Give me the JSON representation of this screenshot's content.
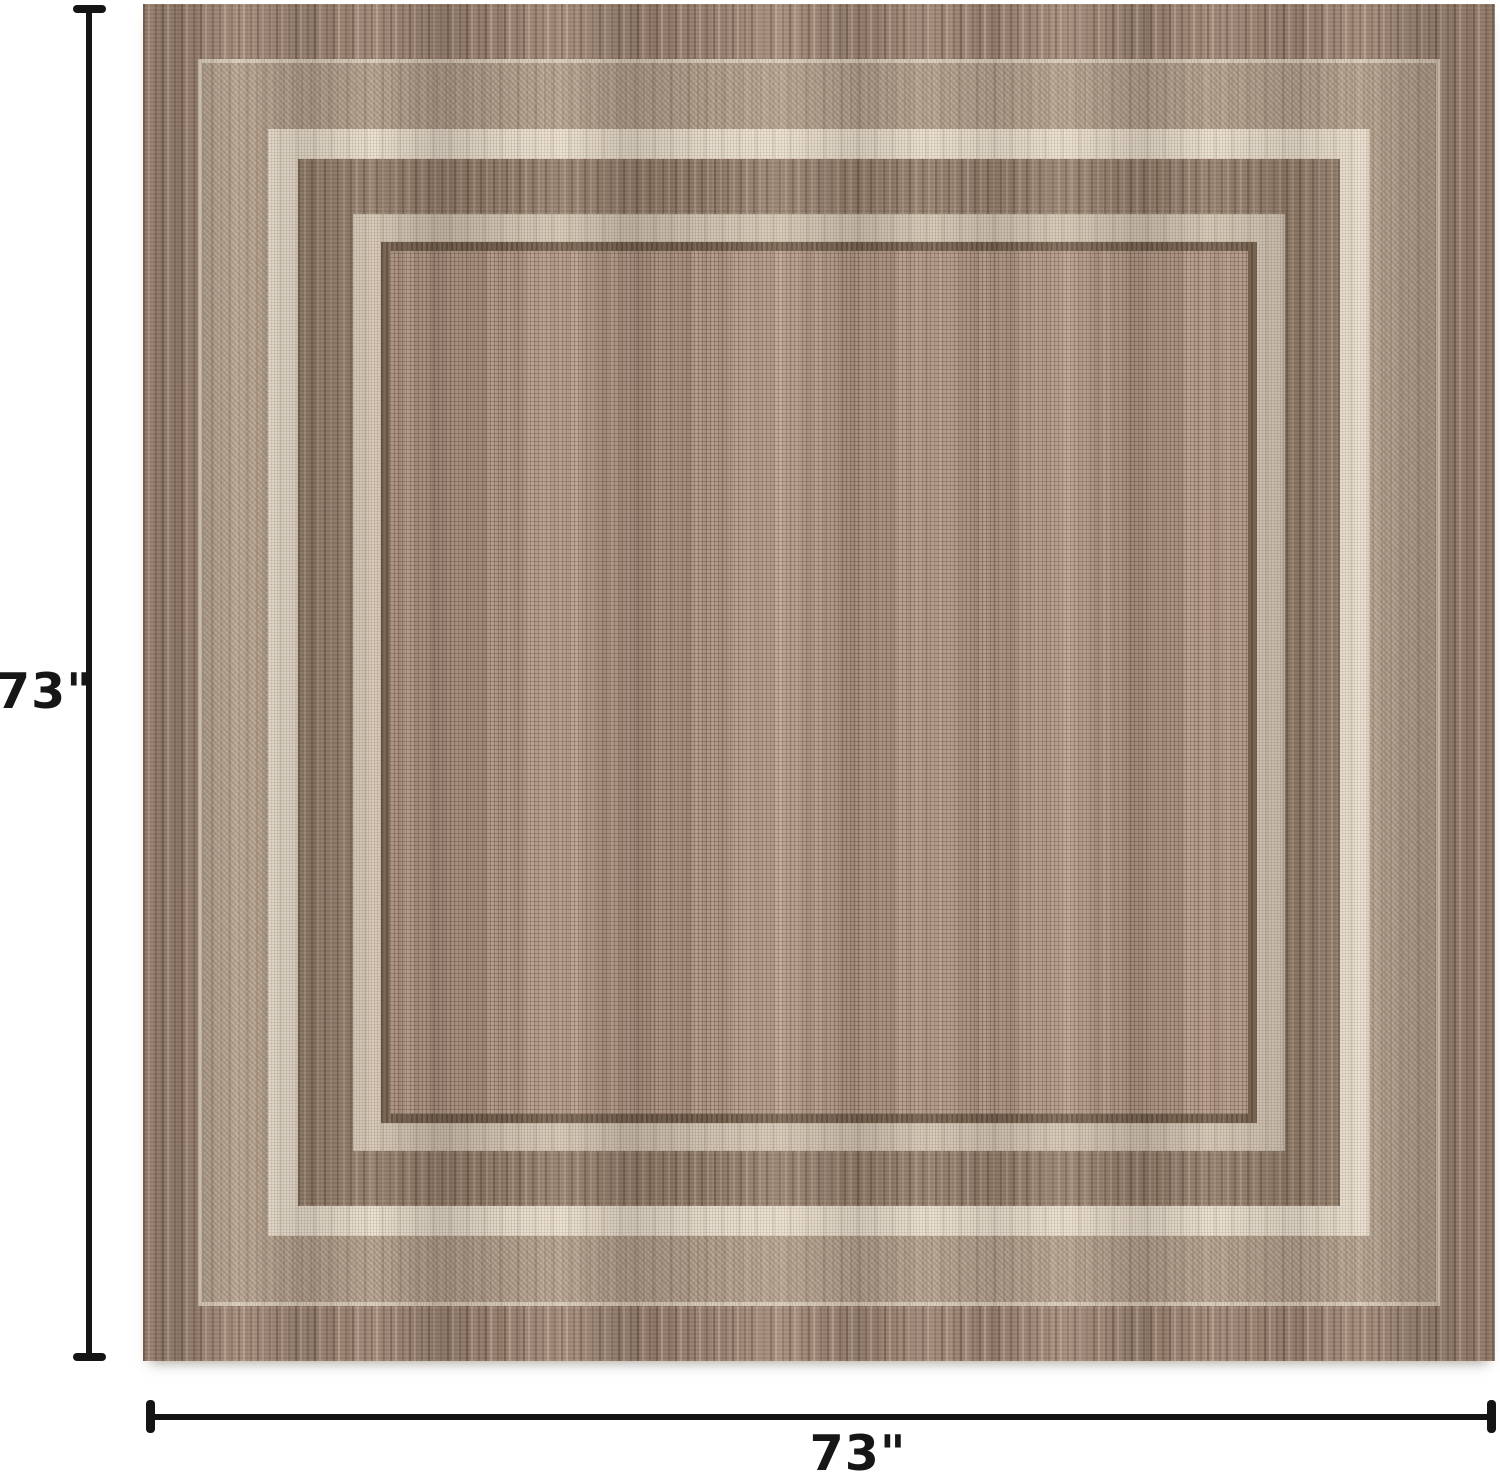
{
  "image": {
    "type": "product-dimension-photo",
    "subject": "square two-tone brown flatweave area rug with layered cream border frames",
    "height_label": "73\"",
    "width_label": "73\""
  },
  "colors": {
    "page_bg": "#ffffff",
    "dimension_line": "#141414",
    "label_text": "#161616",
    "rug_outer_band": "#9a8271",
    "rug_taupe_band": "#b5a28f",
    "rug_cream_band": "#ebe2d4",
    "rug_brown_band": "#8f7a67",
    "rug_pale_line": "#d5c9b9",
    "rug_dark_line": "#77634f",
    "rug_field": "#b69d8a",
    "rug_edge_line": "#d9ccbc"
  }
}
